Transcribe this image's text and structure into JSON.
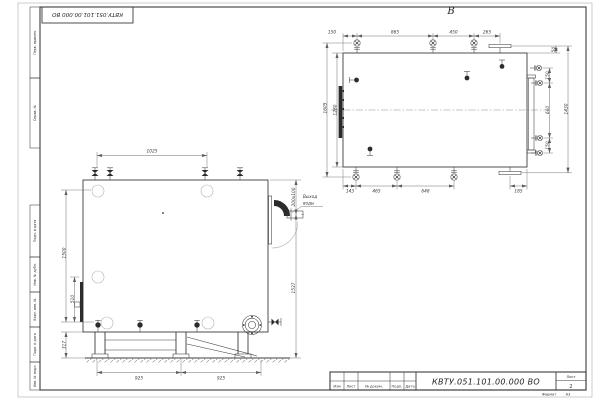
{
  "sheet": {
    "top_stamp": "КВТУ.051.101.00.000  ВО",
    "margin_labels": [
      "Перв. примен.",
      "Справ. №",
      "Подп. и дата",
      "Инв. № дубл.",
      "Взам. инв. №",
      "Подп. и дата",
      "Инв. № подл."
    ],
    "format_label": "Формат",
    "format_value": "А3"
  },
  "title_block": {
    "designation": "КВТУ.051.101.00.000  ВО",
    "columns": [
      "Изм",
      "Лист",
      "№ докум.",
      "Подп.",
      "Дата"
    ],
    "sheet_label": "Лист",
    "sheet_number": "2"
  },
  "views": {
    "top": {
      "label": "В",
      "dims_top": [
        "150",
        "865",
        "450",
        "265"
      ],
      "dim_top_right": "50",
      "dims_right": [
        "150",
        "660",
        "150"
      ],
      "dim_right_total": "1430",
      "dims_left": [
        "1605",
        "1280"
      ],
      "dims_bottom": [
        "143",
        "465",
        "648",
        "185"
      ]
    },
    "front": {
      "dim_top": "1025",
      "dims_left": [
        "1500",
        "510",
        "317"
      ],
      "dims_right": [
        "200х100",
        "1537"
      ],
      "dims_bottom": [
        "925",
        "925"
      ],
      "note_line1": "Выход",
      "note_line2": "воды"
    }
  }
}
